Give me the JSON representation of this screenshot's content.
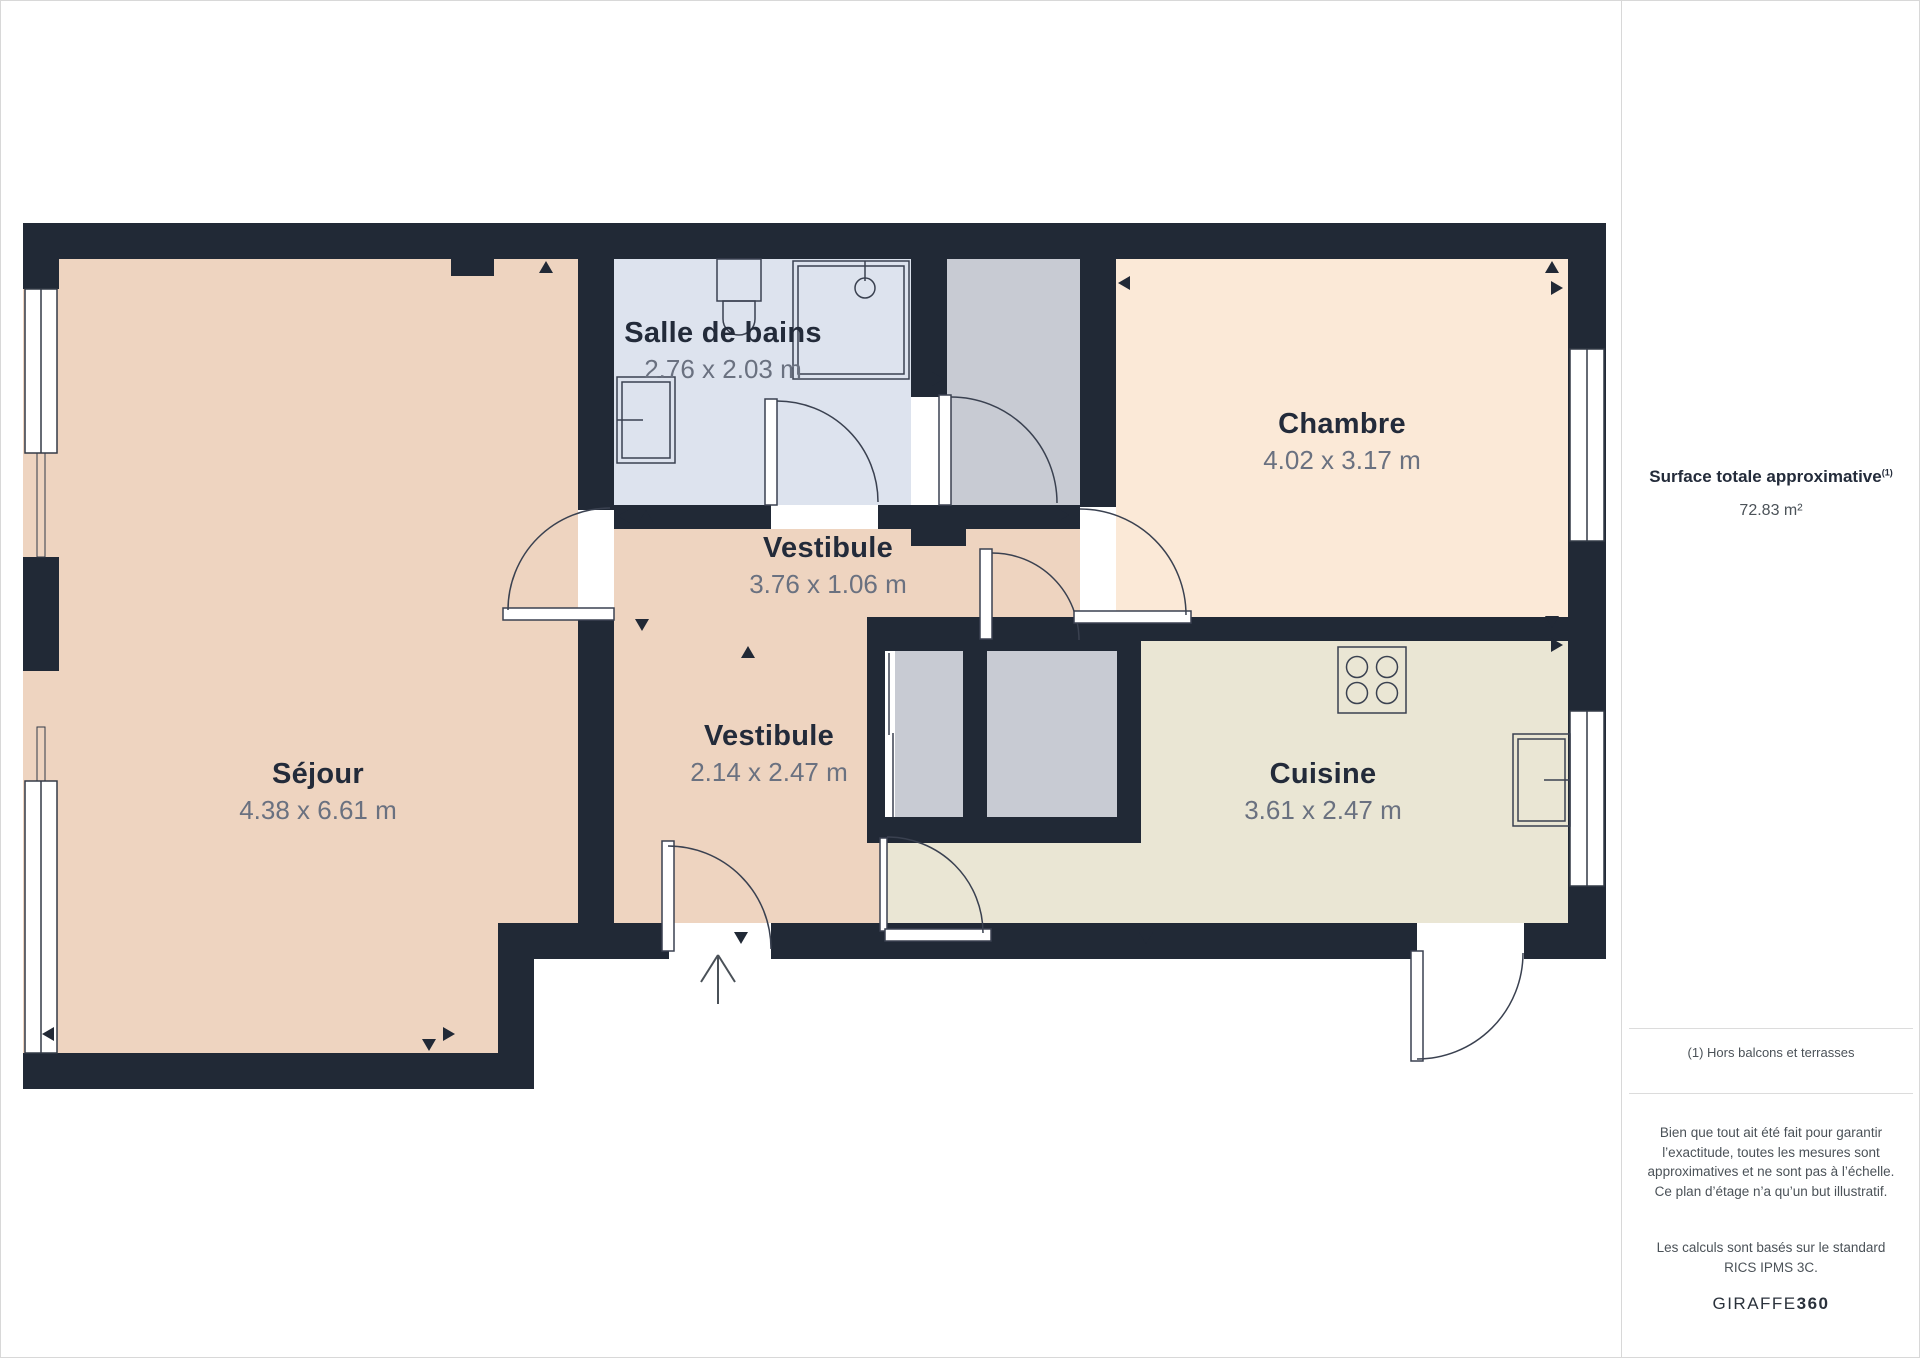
{
  "floor_plan": {
    "rooms": [
      {
        "id": "sejour",
        "name": "Séjour",
        "dimensions": "4.38 x 6.61 m"
      },
      {
        "id": "salle_de_bains",
        "name": "Salle de bains",
        "dimensions": "2.76 x 2.03 m"
      },
      {
        "id": "vestibule_haut",
        "name": "Vestibule",
        "dimensions": "3.76 x 1.06 m"
      },
      {
        "id": "vestibule_bas",
        "name": "Vestibule",
        "dimensions": "2.14 x 2.47 m"
      },
      {
        "id": "chambre",
        "name": "Chambre",
        "dimensions": "4.02 x 3.17 m"
      },
      {
        "id": "cuisine",
        "name": "Cuisine",
        "dimensions": "3.61 x 2.47 m"
      }
    ],
    "colors": {
      "wall": "#212936",
      "sejour": "#eed4c0",
      "salle_de_bains": "#dde3ee",
      "vestibule": "#eed4c0",
      "chambre": "#fbe9d7",
      "cuisine": "#eae6d4",
      "placard": "#c8cbd3"
    }
  },
  "sidebar": {
    "surface_title": "Surface totale approximative",
    "surface_title_superscript": "(1)",
    "surface_value": "72.83 m²",
    "footnote": "(1) Hors balcons et terrasses",
    "disclaimer_1": "Bien que tout ait été fait pour garantir l’exactitude, toutes les mesures sont approximatives et ne sont pas à l’échelle. Ce plan d’étage n’a qu’un but illustratif.",
    "disclaimer_2": "Les calculs sont basés sur le standard RICS IPMS 3C.",
    "brand_regular": "GIRAFFE",
    "brand_bold": "360"
  }
}
